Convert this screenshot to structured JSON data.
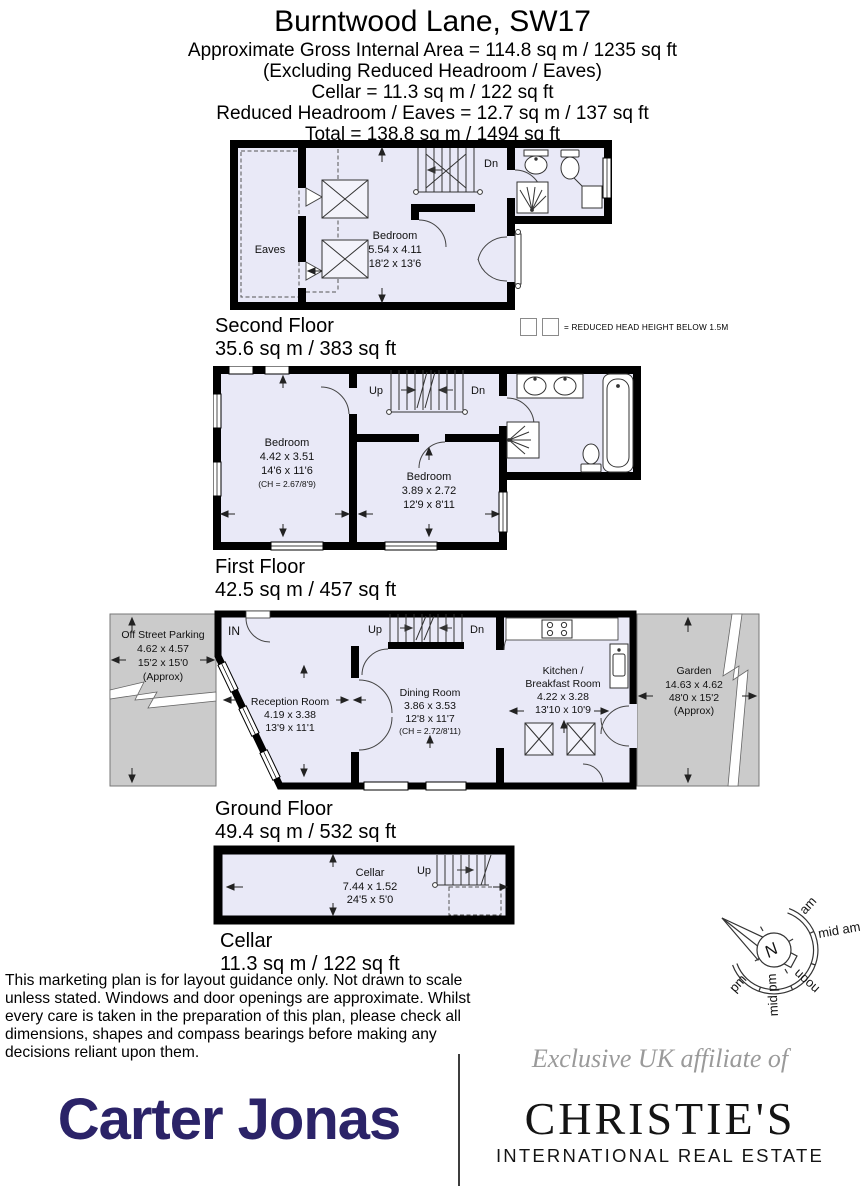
{
  "header": {
    "title": "Burntwood Lane, SW17",
    "line1": "Approximate Gross Internal Area = 114.8 sq m / 1235 sq ft",
    "line2": "(Excluding Reduced Headroom / Eaves)",
    "line3": "Cellar = 11.3 sq m / 122 sq ft",
    "line4": "Reduced Headroom / Eaves = 12.7 sq m / 137 sq ft",
    "line5": "Total = 138.8 sq m / 1494 sq ft"
  },
  "legend": {
    "text": "= REDUCED HEAD HEIGHT BELOW 1.5M"
  },
  "floors": {
    "second": {
      "name": "Second Floor",
      "area": "35.6 sq m / 383 sq ft",
      "eaves": "Eaves",
      "dn": "Dn",
      "bedroom": {
        "name": "Bedroom",
        "metric": "5.54 x 4.11",
        "imperial": "18'2 x 13'6"
      }
    },
    "first": {
      "name": "First Floor",
      "area": "42.5 sq m / 457 sq ft",
      "up": "Up",
      "dn": "Dn",
      "bedroom1": {
        "name": "Bedroom",
        "metric": "4.42 x 3.51",
        "imperial": "14'6 x 11'6",
        "ch": "(CH = 2.67/8'9)"
      },
      "bedroom2": {
        "name": "Bedroom",
        "metric": "3.89 x 2.72",
        "imperial": "12'9 x 8'11"
      }
    },
    "ground": {
      "name": "Ground Floor",
      "area": "49.4 sq m / 532 sq ft",
      "up": "Up",
      "dn": "Dn",
      "in_label": "IN",
      "parking": {
        "name": "Off Street Parking",
        "metric": "4.62 x 4.57",
        "imperial": "15'2 x 15'0",
        "approx": "(Approx)"
      },
      "reception": {
        "name": "Reception Room",
        "metric": "4.19 x 3.38",
        "imperial": "13'9 x 11'1"
      },
      "dining": {
        "name": "Dining Room",
        "metric": "3.86 x 3.53",
        "imperial": "12'8 x 11'7",
        "ch": "(CH = 2.72/8'11)"
      },
      "kitchen": {
        "name1": "Kitchen /",
        "name2": "Breakfast Room",
        "metric": "4.22 x 3.28",
        "imperial": "13'10 x 10'9"
      },
      "garden": {
        "name": "Garden",
        "metric": "14.63 x 4.62",
        "imperial": "48'0 x 15'2",
        "approx": "(Approx)"
      }
    },
    "cellar": {
      "name": "Cellar",
      "area": "11.3 sq m / 122 sq ft",
      "up": "Up",
      "room": {
        "name": "Cellar",
        "metric": "7.44 x 1.52",
        "imperial": "24'5 x 5'0"
      }
    }
  },
  "compass": {
    "north": "N",
    "labels": [
      "am",
      "mid am",
      "noon",
      "mid pm",
      "pm"
    ]
  },
  "disclaimer": "This marketing plan is for layout guidance only. Not drawn to scale unless stated. Windows and door openings are approximate. Whilst every care is taken in the preparation of this plan, please check all dimensions, shapes and compass bearings before making any decisions reliant upon them.",
  "footer": {
    "carter_jonas": "Carter Jonas",
    "affiliate": "Exclusive UK affiliate of",
    "christies": "CHRISTIE'S",
    "christies_sub": "INTERNATIONAL REAL ESTATE"
  },
  "colors": {
    "room_fill": "#e9e9f7",
    "outdoor_fill": "#cbcbcb",
    "wall": "#000000",
    "carter_navy": "#2b2368"
  }
}
